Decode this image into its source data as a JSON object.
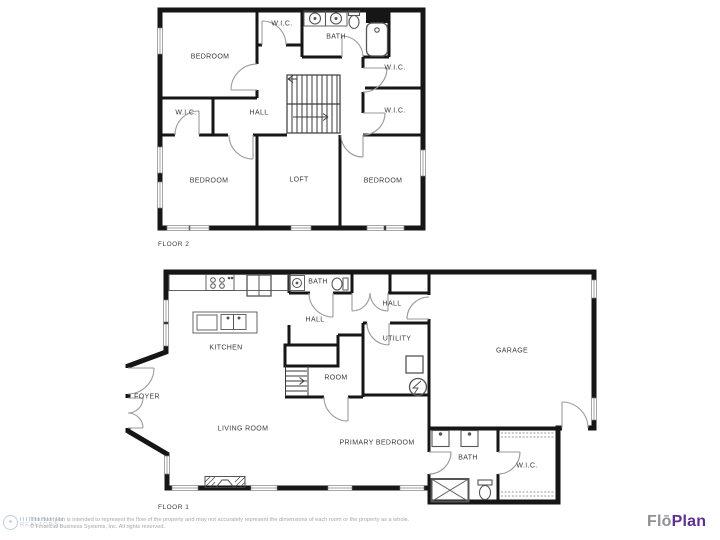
{
  "floor2": {
    "floor_label": "FLOOR 2",
    "rooms": [
      {
        "label": "BEDROOM"
      },
      {
        "label": "W.I.C."
      },
      {
        "label": "BATH"
      },
      {
        "label": "W.I.C."
      },
      {
        "label": "W.I.C."
      },
      {
        "label": "W.I.C."
      },
      {
        "label": "HALL"
      },
      {
        "label": "BEDROOM"
      },
      {
        "label": "LOFT"
      },
      {
        "label": "BEDROOM"
      }
    ]
  },
  "floor1": {
    "floor_label": "FLOOR 1",
    "rooms": [
      {
        "label": "BATH"
      },
      {
        "label": "HALL"
      },
      {
        "label": "HALL"
      },
      {
        "label": "KITCHEN"
      },
      {
        "label": "UTILITY"
      },
      {
        "label": "ROOM"
      },
      {
        "label": "GARAGE"
      },
      {
        "label": "FOYER"
      },
      {
        "label": "LIVING ROOM"
      },
      {
        "label": "PRIMARY BEDROOM"
      },
      {
        "label": "BATH"
      },
      {
        "label": "W.I.C."
      }
    ]
  },
  "footer": {
    "disclaimer_line1": "This floor plan is intended to represent the flow of the property and may not accurately represent the dimensions of each room or the property as a whole.",
    "disclaimer_line2": "© Financial Business Systems, Inc. All rights reserved.",
    "watermark_text": "REALTORS",
    "logo_part1": "Flō",
    "logo_part2": "Plan"
  },
  "colors": {
    "wall": "#161616",
    "door_arc": "#9a9a9a",
    "logo_flo": "#8f8f96",
    "logo_plan": "#5f2e91",
    "watermark_blue": "#6a93c0"
  }
}
